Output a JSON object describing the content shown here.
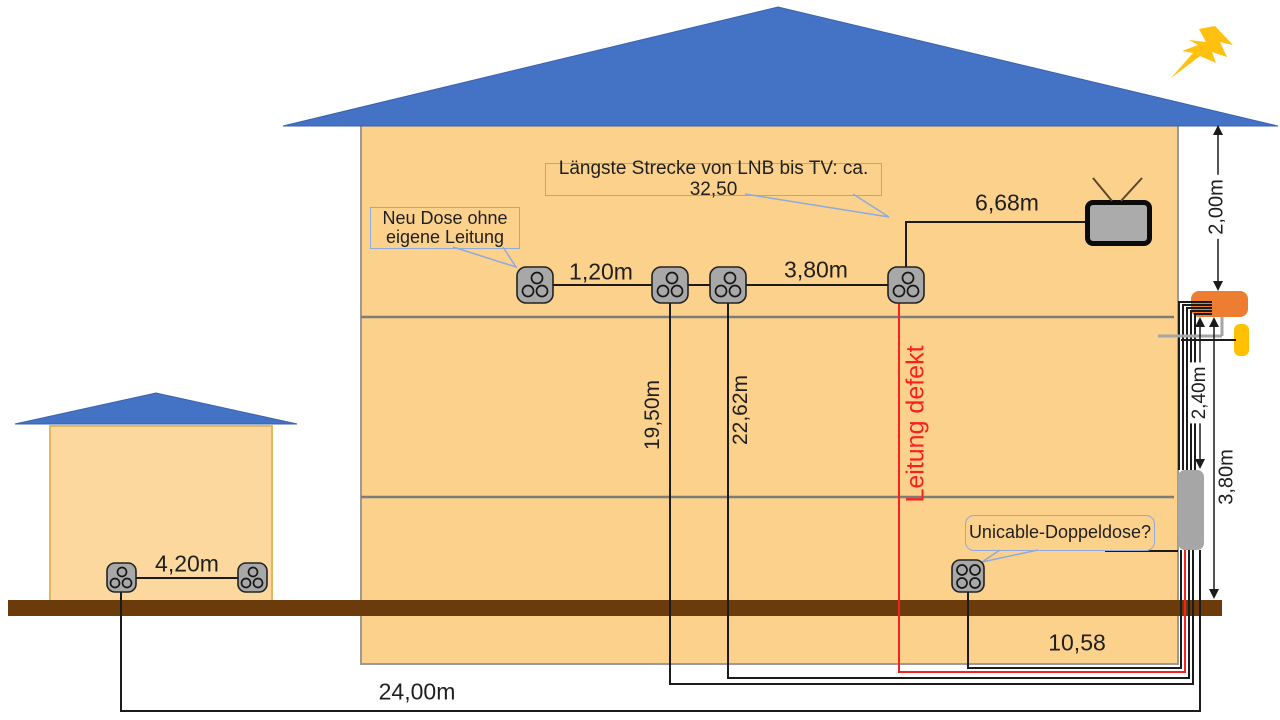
{
  "colors": {
    "roof_blue": "#4472C4",
    "wall_orange": "#FBD18C",
    "wall_orange_light": "#FCD89E",
    "house_border": "#9a9a96",
    "garage_border": "#E2B85C",
    "ground_brown": "#6C3B0C",
    "box_orange": "#ED7D31",
    "box_yellow": "#FFC000",
    "box_gray": "#A6A6A6",
    "outlet_gray": "#A8A8A8",
    "cable": "#1b1b1b",
    "defect_red": "#F92020",
    "callout_blue": "#8FAADC",
    "lightning": "#FFC010",
    "text": "#1f1f1f",
    "floor_line": "#7d7d78",
    "tv_screen": "#ABABAB"
  },
  "callouts": {
    "longest_run": "Längste Strecke von LNB bis TV: ca. 32,50",
    "new_outlet_line1": "Neu Dose ohne",
    "new_outlet_line2": "eigene Leitung",
    "unicable": "Unicable-Doppeldose?"
  },
  "measurements": {
    "attic_run": "6,68m",
    "gap_small": "1,20m",
    "gap_large": "3,80m",
    "drop_a": "19,50m",
    "drop_b": "22,62m",
    "defect": "Leitung defekt",
    "height_roof": "2,00m",
    "height_duct": "2,40m",
    "height_ground": "3,80m",
    "garage_gap": "4,20m",
    "garage_run": "24,00m",
    "unicable_run": "10,58"
  },
  "icons": {
    "lightning": "lightning-icon",
    "tv": "tv-icon",
    "outlet3": "outlet-3port-icon",
    "outlet4": "outlet-4port-icon",
    "multiswitch": "multiswitch-box",
    "power_inserter": "power-inserter-box",
    "duct": "cable-duct-box"
  }
}
